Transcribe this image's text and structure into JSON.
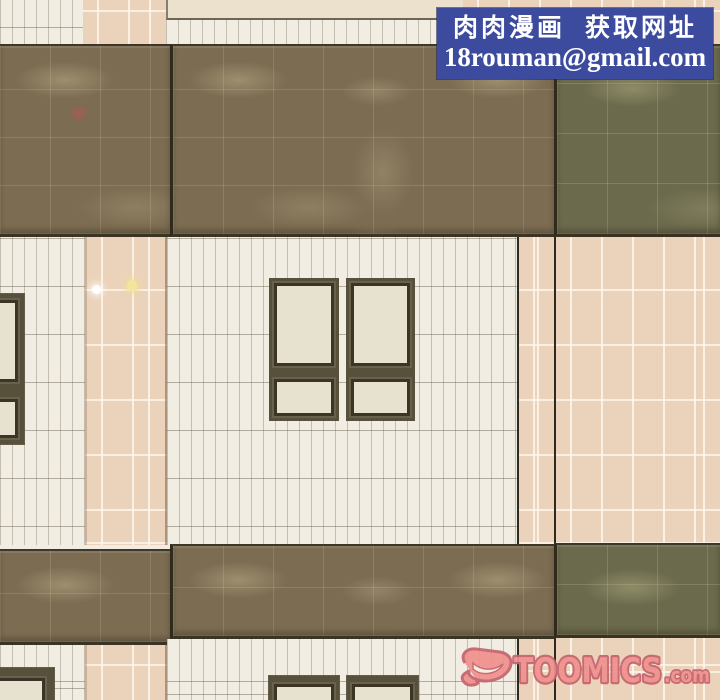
{
  "page_type": "webtoon-comic-panel",
  "overlay_banner": {
    "line1": "肉肉漫画  获取网址",
    "line2": "18rouman@gmail.com",
    "bg_color": "#3c4b9e",
    "text_color": "#ffffff"
  },
  "watermark": {
    "brand": "TOOMICS",
    "suffix": ".com",
    "logo": "toomics-d-logo",
    "fill_color": "#f0908e",
    "outline_color": "#c4636d"
  },
  "scene": {
    "description": "exterior tiled building wall, two floors, marble accent bands, double-sash windows",
    "palette": {
      "white_tile": "#f1ede3",
      "cream_tile": "#ece1cc",
      "pink_tile": "#ebd3bb",
      "brown_marble": "#7c6c52",
      "green_marble": "#6b6a4c",
      "window_frame": "#57503a",
      "window_glass": "#e7e1d0",
      "seam_dark": "#302a1c"
    },
    "effects": [
      {
        "name": "red-smudge"
      },
      {
        "name": "sparkle-white"
      },
      {
        "name": "sparkle-yellow"
      }
    ],
    "windows": {
      "main_window_sashes": 2,
      "left_edge_window_partial": 1,
      "bottom_windows_partial": 3
    }
  }
}
